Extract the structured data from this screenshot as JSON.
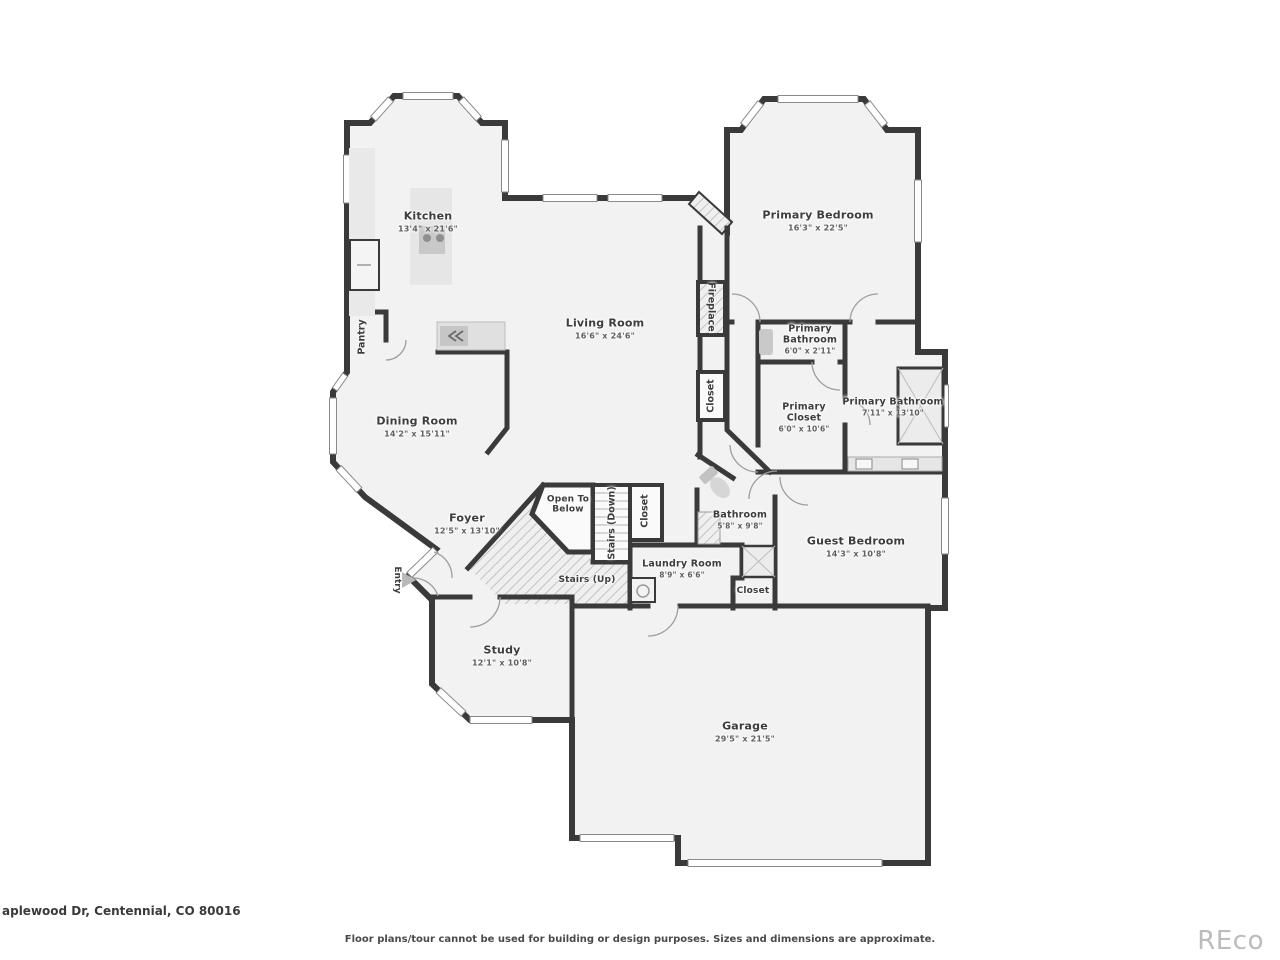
{
  "page": {
    "address": "aplewood Dr, Centennial, CO 80016",
    "disclaimer": "Floor plans/tour cannot be used for building or design purposes. Sizes and dimensions are approximate.",
    "watermark": "REco"
  },
  "colors": {
    "wall": "#3a3a3a",
    "room_fill": "#f2f2f2",
    "fixture_fill": "#e2e2e2",
    "label_text": "#3d3d3d",
    "watermark": "#bcbcbc"
  },
  "rooms": {
    "kitchen": {
      "name": "Kitchen",
      "dims": "13'4\" x 21'6\""
    },
    "living_room": {
      "name": "Living Room",
      "dims": "16'6\" x 24'6\""
    },
    "primary_bedroom": {
      "name": "Primary Bedroom",
      "dims": "16'3\" x 22'5\""
    },
    "primary_bathroom_small": {
      "name": "Primary Bathroom",
      "dims": "6'0\" x 2'11\""
    },
    "primary_closet": {
      "name": "Primary Closet",
      "dims": "6'0\" x 10'6\""
    },
    "primary_bathroom": {
      "name": "Primary Bathroom",
      "dims": "7'11\" x 13'10\""
    },
    "dining_room": {
      "name": "Dining Room",
      "dims": "14'2\" x 15'11\""
    },
    "foyer": {
      "name": "Foyer",
      "dims": "12'5\" x 13'10\""
    },
    "bathroom": {
      "name": "Bathroom",
      "dims": "5'8\" x 9'8\""
    },
    "laundry_room": {
      "name": "Laundry Room",
      "dims": "8'9\" x 6'6\""
    },
    "guest_bedroom": {
      "name": "Guest Bedroom",
      "dims": "14'3\" x 10'8\""
    },
    "study": {
      "name": "Study",
      "dims": "12'1\" x 10'8\""
    },
    "garage": {
      "name": "Garage",
      "dims": "29'5\" x 21'5\""
    }
  },
  "annotations": {
    "pantry": "Pantry",
    "fireplace": "Fireplace",
    "closet_living": "Closet",
    "closet_stairs": "Closet",
    "closet_hall": "Closet",
    "open_to_below": "Open To Below",
    "stairs_down": "Stairs (Down)",
    "stairs_up": "Stairs (Up)",
    "entry": "Entry"
  }
}
